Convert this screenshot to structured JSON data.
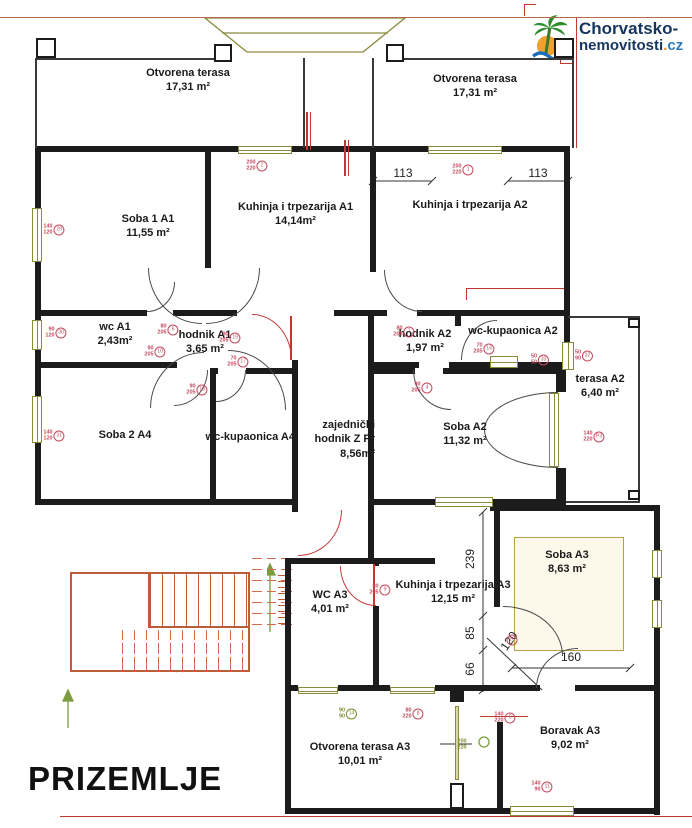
{
  "title": "PRIZEMLJE",
  "logo": {
    "line1": "Chorvatsko-",
    "line2_main": "nemovitosti",
    "line2_dot": ".",
    "line2_tld": "cz",
    "icon": "palm-tree-icon"
  },
  "rooms": [
    {
      "id": "otvorena-terasa-left",
      "label": "Otvorena terasa",
      "area": "17,31 m²",
      "x": 98,
      "y": 66,
      "w": 180
    },
    {
      "id": "otvorena-terasa-right",
      "label": "Otvorena terasa",
      "area": "17,31 m²",
      "x": 385,
      "y": 72,
      "w": 180
    },
    {
      "id": "soba-1-a1",
      "label": "Soba 1 A1",
      "area": "11,55 m²",
      "x": 78,
      "y": 212,
      "w": 140
    },
    {
      "id": "kuhinja-trpezarija-a1",
      "label": "Kuhinja i trpezarija A1",
      "area": "14,14m²",
      "x": 228,
      "y": 200,
      "w": 135
    },
    {
      "id": "kuhinja-trpezarija-a2",
      "label": "Kuhinja i trpezarija A2",
      "area": "",
      "x": 400,
      "y": 198,
      "w": 140
    },
    {
      "id": "wc-a1",
      "label": "wc A1",
      "area": "2,43m²",
      "x": 55,
      "y": 320,
      "w": 120
    },
    {
      "id": "hodnik-a1",
      "label": "hodnik A1",
      "area": "3,65 m²",
      "x": 145,
      "y": 328,
      "w": 120
    },
    {
      "id": "hodnik-a2",
      "label": "hodnik A2",
      "area": "1,97 m²",
      "x": 375,
      "y": 327,
      "w": 100
    },
    {
      "id": "wc-kupaonica-a2",
      "label": "wc-kupaonica A2",
      "area": "",
      "x": 448,
      "y": 324,
      "w": 130
    },
    {
      "id": "terasa-a2",
      "label": "terasa A2",
      "area": "6,40 m²",
      "x": 540,
      "y": 372,
      "w": 120
    },
    {
      "id": "soba-2-a4",
      "label": "Soba 2 A4",
      "area": "",
      "x": 65,
      "y": 428,
      "w": 120
    },
    {
      "id": "wc-kupaonica-a4",
      "label": "wc-kupaonica A4",
      "area": "",
      "x": 200,
      "y": 430,
      "w": 95,
      "align": "right"
    },
    {
      "id": "zajednicki-hodnik-z-pr",
      "label": "zajednički hodnik Z Pr",
      "area": "8,56m²",
      "x": 299,
      "y": 418,
      "w": 76,
      "align": "right"
    },
    {
      "id": "soba-a2",
      "label": "Soba A2",
      "area": "11,32 m²",
      "x": 405,
      "y": 420,
      "w": 120
    },
    {
      "id": "soba-a3",
      "label": "Soba A3",
      "area": "8,63 m²",
      "x": 507,
      "y": 548,
      "w": 120
    },
    {
      "id": "wc-a3",
      "label": "WC A3",
      "area": "4,01 m²",
      "x": 270,
      "y": 588,
      "w": 120
    },
    {
      "id": "kuhinja-trpezarija-a3",
      "label": "Kuhinja i trpezarija A3",
      "area": "12,15 m²",
      "x": 388,
      "y": 578,
      "w": 130
    },
    {
      "id": "otvorena-terasa-a3",
      "label": "Otvorena terasa A3",
      "area": "10,01 m²",
      "x": 270,
      "y": 740,
      "w": 180
    },
    {
      "id": "boravak-a3",
      "label": "Boravak A3",
      "area": "9,02 m²",
      "x": 500,
      "y": 724,
      "w": 140
    }
  ],
  "dims": {
    "left113": "113",
    "right113": "113",
    "v239": "239",
    "v85": "85",
    "v66": "66",
    "h160": "160",
    "d120": "120"
  },
  "markers": [
    {
      "size": "200/220",
      "ref": "2",
      "x": 257,
      "y": 166,
      "tone": "red"
    },
    {
      "size": "200/220",
      "ref": "1",
      "x": 463,
      "y": 170,
      "tone": "red"
    },
    {
      "size": "140/120",
      "ref": "29",
      "x": 54,
      "y": 230,
      "tone": "red"
    },
    {
      "size": "90/120",
      "ref": "30",
      "x": 56,
      "y": 333,
      "tone": "red"
    },
    {
      "size": "140/120",
      "ref": "31",
      "x": 54,
      "y": 436,
      "tone": "red"
    },
    {
      "size": "80/205",
      "ref": "6",
      "x": 168,
      "y": 330,
      "tone": "red"
    },
    {
      "size": "90/205",
      "ref": "10",
      "x": 155,
      "y": 352,
      "tone": "red"
    },
    {
      "size": "90/205",
      "ref": "13",
      "x": 197,
      "y": 390,
      "tone": "red"
    },
    {
      "size": "90/205",
      "ref": "19",
      "x": 230,
      "y": 338,
      "tone": "red"
    },
    {
      "size": "70/205",
      "ref": "17",
      "x": 238,
      "y": 362,
      "tone": "red"
    },
    {
      "size": "80/205",
      "ref": "7",
      "x": 404,
      "y": 332,
      "tone": "red"
    },
    {
      "size": "90/205",
      "ref": "4",
      "x": 422,
      "y": 388,
      "tone": "red"
    },
    {
      "size": "70/205",
      "ref": "14",
      "x": 484,
      "y": 349,
      "tone": "red"
    },
    {
      "size": "50/50",
      "ref": "33",
      "x": 540,
      "y": 360,
      "tone": "red"
    },
    {
      "size": "50/90",
      "ref": "32",
      "x": 584,
      "y": 356,
      "tone": "red"
    },
    {
      "size": "140/220",
      "ref": "P3",
      "x": 594,
      "y": 437,
      "tone": "red"
    },
    {
      "size": "80/205",
      "ref": "9",
      "x": 380,
      "y": 590,
      "tone": "red"
    },
    {
      "size": "",
      "ref": "26",
      "x": 512,
      "y": 640,
      "tone": "red"
    },
    {
      "size": "90/90",
      "ref": "14",
      "x": 348,
      "y": 714,
      "tone": "olive"
    },
    {
      "size": "80/220",
      "ref": "8",
      "x": 413,
      "y": 714,
      "tone": "red"
    },
    {
      "size": "140/220",
      "ref": "5",
      "x": 505,
      "y": 718,
      "tone": "red"
    },
    {
      "size": "140/90",
      "ref": "11",
      "x": 542,
      "y": 787,
      "tone": "red"
    },
    {
      "size": "200/220",
      "ref": "",
      "x": 462,
      "y": 745,
      "tone": "olive"
    }
  ],
  "colors": {
    "wall": "#1c1c1c",
    "accent_red": "#c0392b",
    "marker_red": "#c24b5e",
    "olive": "#8a8a3d",
    "stairs_orange": "#bf5b36",
    "arrow_green": "#7d9c40",
    "logo_navy": "#16355f",
    "logo_orange": "#e8922a",
    "logo_blue": "#2e7cb8"
  }
}
